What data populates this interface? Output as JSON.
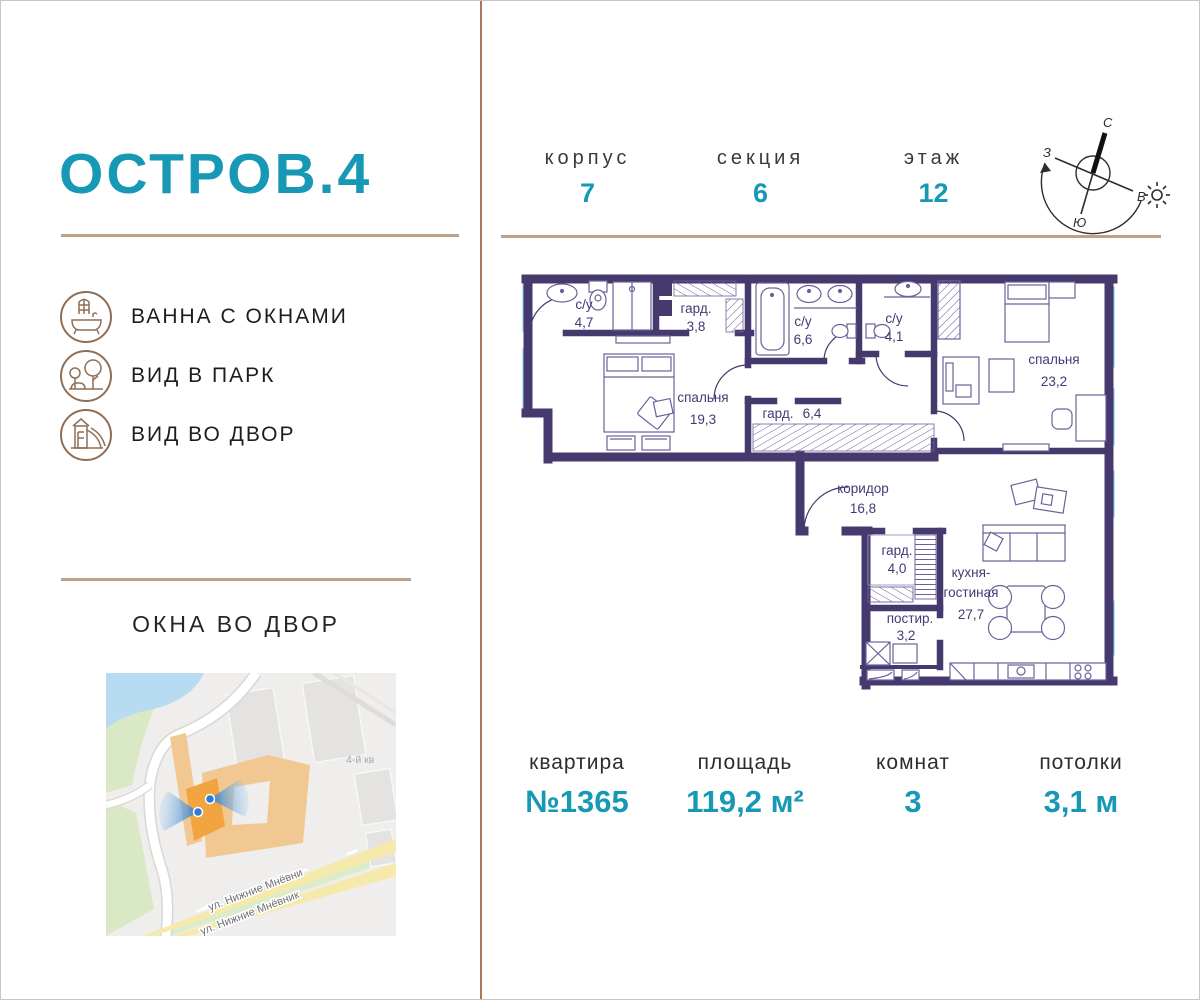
{
  "brand": {
    "logo": "ОСТРОВ.4"
  },
  "header": {
    "stats": [
      {
        "label": "корпус",
        "value": "7"
      },
      {
        "label": "секция",
        "value": "6"
      },
      {
        "label": "этаж",
        "value": "12"
      }
    ],
    "compass": {
      "north": "С",
      "south": "Ю",
      "west": "З",
      "east": "В"
    }
  },
  "features": [
    {
      "icon": "bath-with-window-icon",
      "label": "ВАННА С ОКНАМИ"
    },
    {
      "icon": "park-view-icon",
      "label": "ВИД В ПАРК"
    },
    {
      "icon": "courtyard-view-icon",
      "label": "ВИД ВО ДВОР"
    }
  ],
  "map": {
    "title": "ОКНА ВО ДВОР",
    "district_label": "4-й кв",
    "street_label_top": "ул. Нижние Мнёвни",
    "street_label_bottom": "ул. Нижние Мнёвник"
  },
  "plan": {
    "rooms": [
      {
        "name": "с/у",
        "area": "4,7"
      },
      {
        "name": "гард.",
        "area": "3,8"
      },
      {
        "name": "с/у",
        "area": "6,6"
      },
      {
        "name": "с/у",
        "area": "4,1"
      },
      {
        "name": "спальня",
        "area": "23,2"
      },
      {
        "name": "спальня",
        "area": "19,3"
      },
      {
        "name": "гард.",
        "area": "6,4"
      },
      {
        "name": "коридор",
        "area": "16,8"
      },
      {
        "name": "гард.",
        "area": "4,0"
      },
      {
        "name": "постир.",
        "area": "3,2"
      },
      {
        "name": "кухня-",
        "name2": "гостиная",
        "area": "27,7"
      }
    ]
  },
  "summary": {
    "stats": [
      {
        "label": "квартира",
        "value": "№1365"
      },
      {
        "label": "площадь",
        "value": "119,2 м²"
      },
      {
        "label": "комнат",
        "value": "3"
      },
      {
        "label": "потолки",
        "value": "3,1 м"
      }
    ]
  },
  "colors": {
    "accent_teal": "#1798b4",
    "line_tan": "#bda189",
    "icon_brown": "#8f6e55",
    "wall_purple": "#46396e",
    "window_blue": "#9fd8f0"
  }
}
